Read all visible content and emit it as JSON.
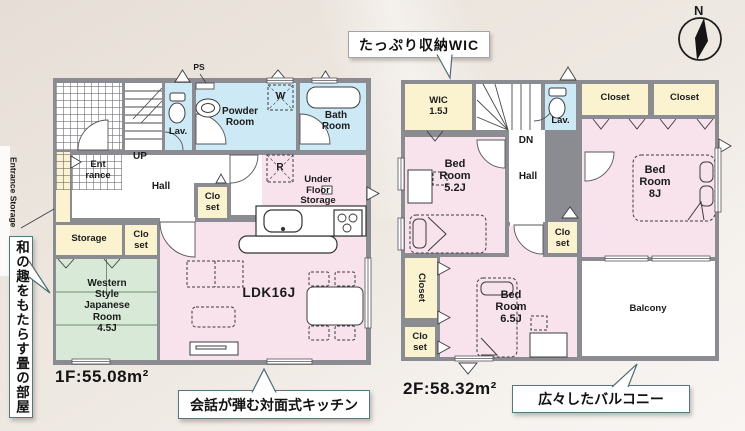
{
  "compass": {
    "north_label": "N"
  },
  "floor1": {
    "area_label": "1F:55.08m²",
    "labels": {
      "entrance_storage": "Entrance Storage",
      "ps": "PS",
      "lav": "Lav.",
      "powder_room": "Powder\nRoom",
      "washer": "W",
      "bath_room": "Bath\nRoom",
      "up": "UP",
      "entrance": "Ent\nrance",
      "hall": "Hall",
      "closet_hall": "Clo\nset",
      "storage": "Storage",
      "closet2": "Clo\nset",
      "japanese_room": "Western\nStyle\nJapanese\nRoom\n4.5J",
      "ldk": "LDK16J",
      "fridge": "R",
      "under_floor_storage": "Under\nFloor\nStorage"
    }
  },
  "floor2": {
    "area_label": "2F:58.32m²",
    "labels": {
      "wic": "WIC\n1.5J",
      "dn": "DN",
      "lav": "Lav.",
      "closet_a": "Closet",
      "closet_b": "Closet",
      "bedroom_52": "Bed\nRoom\n5.2J",
      "hall": "Hall",
      "bedroom_8": "Bed\nRoom\n8J",
      "closet_hall": "Clo\nset",
      "closet_side": "Closet",
      "closet_small": "Clo\nset",
      "bedroom_65": "Bed\nRoom\n6.5J",
      "balcony": "Balcony"
    }
  },
  "callouts": {
    "wic": "たっぷり収納WIC",
    "tatami": "和の趣をもたらす畳の部屋",
    "kitchen": "会話が弾む対面式キッチン",
    "balcony": "広々したバルコニー"
  },
  "colors": {
    "wall": "#8b8b92",
    "room_pink": "#f8e2ec",
    "room_blue": "#cde9f5",
    "room_yellow": "#fbf3d0",
    "room_green": "#d8e9d8",
    "callout_border": "#55767b"
  }
}
